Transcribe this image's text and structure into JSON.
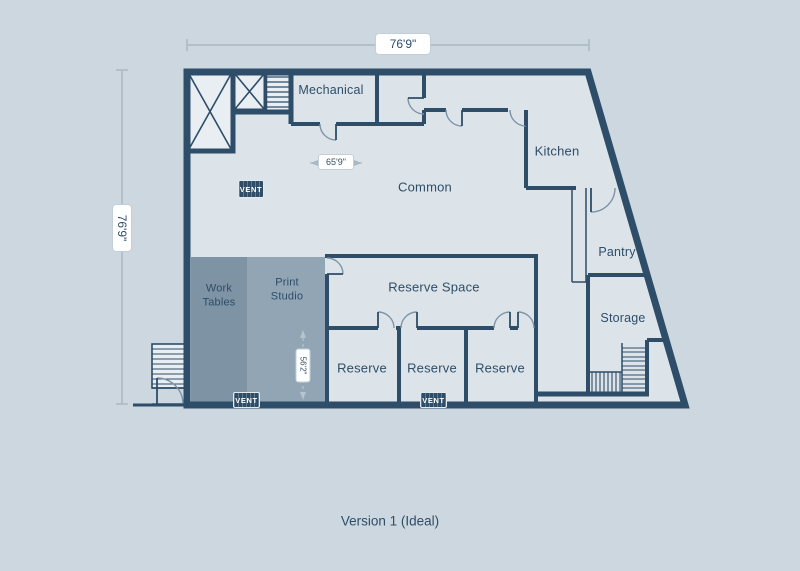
{
  "page": {
    "caption": "Version 1 (Ideal)"
  },
  "rooms": {
    "mechanical": "Mechanical",
    "common": "Common",
    "kitchen": "Kitchen",
    "pantry": "Pantry",
    "storage": "Storage",
    "reserve_space": "Reserve Space",
    "reserve": "Reserve",
    "work_tables": "Work Tables",
    "print_studio": "Print Studio"
  },
  "dimensions": {
    "overall_width": "76'9\"",
    "overall_height": "76'9\"",
    "common_width": "65'9\"",
    "studio_height": "56'2\""
  },
  "fixtures": {
    "vent_label": "VENT"
  },
  "colors": {
    "wall": "#2e4d68",
    "background": "#ccd7df",
    "floor": "#dce4ea",
    "stair_fill": "#e9eef3",
    "work_tables_fill": "#7e93a4",
    "print_studio_fill": "#91a5b5",
    "dimension_line": "#a9b8c3"
  }
}
